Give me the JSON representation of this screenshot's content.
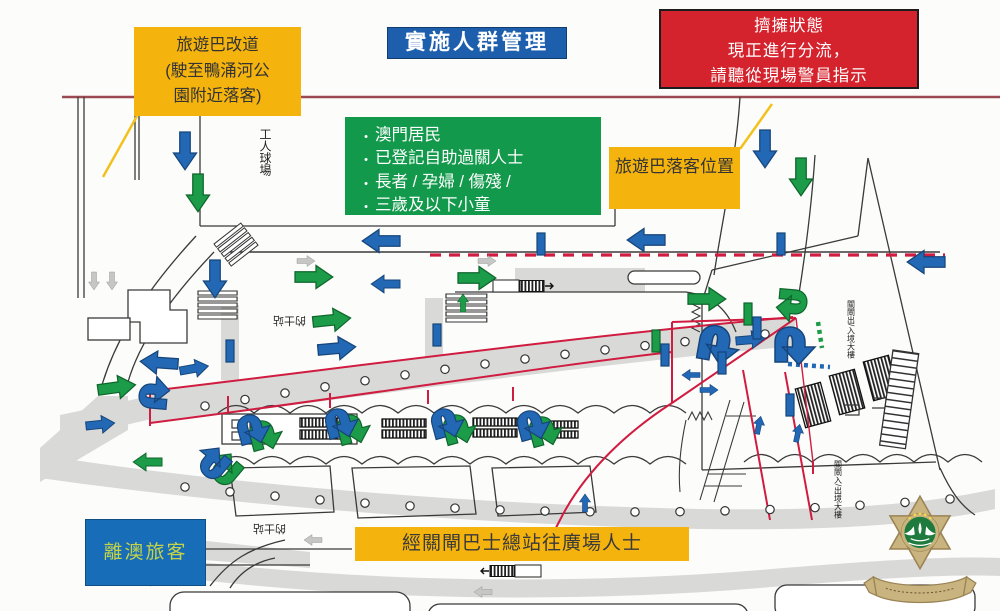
{
  "title": {
    "label": "實施人群管理"
  },
  "callouts": {
    "bus_divert": {
      "text": "旅遊巴改道\n(駛至鴨涌河公\n園附近落客)"
    },
    "congestion_notice": {
      "text": "擠擁狀態\n現正進行分流，\n請聽從現場警員指示"
    },
    "priority_groups": {
      "bullet": "•",
      "items": [
        "澳門居民",
        "已登記自助過關人士",
        "長者 / 孕婦 / 傷殘 /",
        "三歲及以下小童"
      ]
    },
    "bus_dropoff": {
      "text": "旅遊巴落客位置"
    },
    "departing_passengers": {
      "text": "離澳旅客"
    },
    "via_bus_terminal": {
      "text": "經關閘巴士總站往廣場人士"
    }
  },
  "map_labels": {
    "workers_stadium": "工人球場",
    "taxi_stand_upper": "的士站",
    "taxi_stand_lower": "的士站",
    "border_building_upper": "關閘出/入境大樓",
    "border_building_lower": "關閘入/出境大樓"
  },
  "logo": {
    "icon": "macau-security-police-badge"
  },
  "colors": {
    "box_yellow": "#F5B40D",
    "box_green": "#12994B",
    "box_blue": "#1D5FAD",
    "box_red": "#D5232E",
    "title_blue": "#1D5FAD",
    "depart_text_green": "#C4D348",
    "arrow_blue": "#2268B4",
    "arrow_green": "#1C9C48",
    "arrow_gray": "#C6C6C4",
    "route_red": "#D01C40",
    "road_gray": "#D9D9D7",
    "top_rule_maroon": "#9C4A52",
    "badge_gold": "#C9B37E",
    "badge_green": "#1E7B3D"
  },
  "map": {
    "arrows": [
      {
        "k": "L",
        "c": "blue",
        "x": 185,
        "y": 132,
        "r": 90
      },
      {
        "k": "L",
        "c": "green",
        "x": 198,
        "y": 174,
        "r": 90
      },
      {
        "k": "L",
        "c": "blue",
        "x": 765,
        "y": 130,
        "r": 90
      },
      {
        "k": "L",
        "c": "green",
        "x": 801,
        "y": 158,
        "r": 90
      },
      {
        "k": "S",
        "c": "gray",
        "x": 94,
        "y": 272,
        "r": 90
      },
      {
        "k": "S",
        "c": "gray",
        "x": 112,
        "y": 272,
        "r": 90
      },
      {
        "k": "L",
        "c": "blue",
        "x": 400,
        "y": 241,
        "r": 180
      },
      {
        "k": "L",
        "c": "blue",
        "x": 665,
        "y": 240,
        "r": 180
      },
      {
        "k": "L",
        "c": "blue",
        "x": 945,
        "y": 262,
        "r": 180
      },
      {
        "k": "S",
        "c": "gray",
        "x": 297,
        "y": 261,
        "r": 0
      },
      {
        "k": "S",
        "c": "gray",
        "x": 478,
        "y": 261,
        "r": 0
      },
      {
        "k": "L",
        "c": "green",
        "x": 295,
        "y": 277,
        "r": 0
      },
      {
        "k": "L",
        "c": "green",
        "x": 458,
        "y": 278,
        "r": 0
      },
      {
        "k": "M",
        "c": "blue",
        "x": 400,
        "y": 284,
        "r": 180
      },
      {
        "k": "L",
        "c": "blue",
        "x": 215,
        "y": 260,
        "r": 90
      },
      {
        "k": "S",
        "c": "green",
        "x": 463,
        "y": 312,
        "r": -90
      },
      {
        "k": "L",
        "c": "green",
        "x": 313,
        "y": 322,
        "r": -6
      },
      {
        "k": "L",
        "c": "blue",
        "x": 318,
        "y": 350,
        "r": -5
      },
      {
        "k": "L",
        "c": "green",
        "x": 688,
        "y": 299,
        "r": 0
      },
      {
        "k": "M",
        "c": "blue",
        "x": 736,
        "y": 341,
        "r": -5
      },
      {
        "k": "L",
        "c": "blue",
        "x": 178,
        "y": 364,
        "r": 184
      },
      {
        "k": "M",
        "c": "blue",
        "x": 180,
        "y": 371,
        "r": -10
      },
      {
        "k": "L",
        "c": "green",
        "x": 98,
        "y": 390,
        "r": -8
      },
      {
        "k": "M",
        "c": "blue",
        "x": 86,
        "y": 426,
        "r": -6
      },
      {
        "k": "M",
        "c": "green",
        "x": 162,
        "y": 462,
        "r": 180
      },
      {
        "k": "S",
        "c": "blue",
        "x": 700,
        "y": 375,
        "r": 180
      },
      {
        "k": "S",
        "c": "blue",
        "x": 700,
        "y": 390,
        "r": 0
      },
      {
        "k": "S",
        "c": "blue",
        "x": 757,
        "y": 434,
        "r": -78
      },
      {
        "k": "S",
        "c": "blue",
        "x": 796,
        "y": 442,
        "r": -78
      },
      {
        "k": "S",
        "c": "blue",
        "x": 585,
        "y": 512,
        "r": -90
      },
      {
        "k": "S",
        "c": "gray",
        "x": 322,
        "y": 540,
        "r": 180
      },
      {
        "k": "S",
        "c": "gray",
        "x": 492,
        "y": 592,
        "r": 180
      }
    ],
    "hooks": [
      {
        "c": "blue",
        "x": 700,
        "y": 338,
        "r": 10,
        "s": 1.25
      },
      {
        "c": "blue",
        "x": 775,
        "y": 342,
        "r": 0,
        "s": 1.25
      },
      {
        "c": "green",
        "x": 796,
        "y": 290,
        "r": 95,
        "s": 1
      },
      {
        "c": "blue",
        "x": 150,
        "y": 408,
        "r": -85,
        "s": 1
      },
      {
        "c": "green",
        "x": 250,
        "y": 436,
        "r": -15,
        "s": 1
      },
      {
        "c": "blue",
        "x": 238,
        "y": 430,
        "r": -15,
        "s": 1
      },
      {
        "c": "green",
        "x": 338,
        "y": 430,
        "r": -15,
        "s": 1
      },
      {
        "c": "blue",
        "x": 326,
        "y": 424,
        "r": -15,
        "s": 1
      },
      {
        "c": "green",
        "x": 444,
        "y": 430,
        "r": -15,
        "s": 1
      },
      {
        "c": "blue",
        "x": 432,
        "y": 424,
        "r": -15,
        "s": 1
      },
      {
        "c": "green",
        "x": 530,
        "y": 432,
        "r": -15,
        "s": 1
      },
      {
        "c": "blue",
        "x": 518,
        "y": 426,
        "r": -15,
        "s": 1
      },
      {
        "c": "green",
        "x": 234,
        "y": 480,
        "r": -140,
        "s": 1
      },
      {
        "c": "blue",
        "x": 222,
        "y": 474,
        "r": -140,
        "s": 1
      }
    ],
    "bars": [
      {
        "c": "blue",
        "x": 226,
        "y": 340
      },
      {
        "c": "blue",
        "x": 433,
        "y": 324
      },
      {
        "c": "green",
        "x": 744,
        "y": 303
      },
      {
        "c": "blue",
        "x": 753,
        "y": 317
      },
      {
        "c": "blue",
        "x": 718,
        "y": 352
      },
      {
        "c": "green",
        "x": 652,
        "y": 330
      },
      {
        "c": "blue",
        "x": 661,
        "y": 344
      },
      {
        "c": "blue",
        "x": 786,
        "y": 394
      },
      {
        "c": "blue",
        "x": 777,
        "y": 233
      },
      {
        "c": "blue",
        "x": 537,
        "y": 233
      }
    ]
  }
}
